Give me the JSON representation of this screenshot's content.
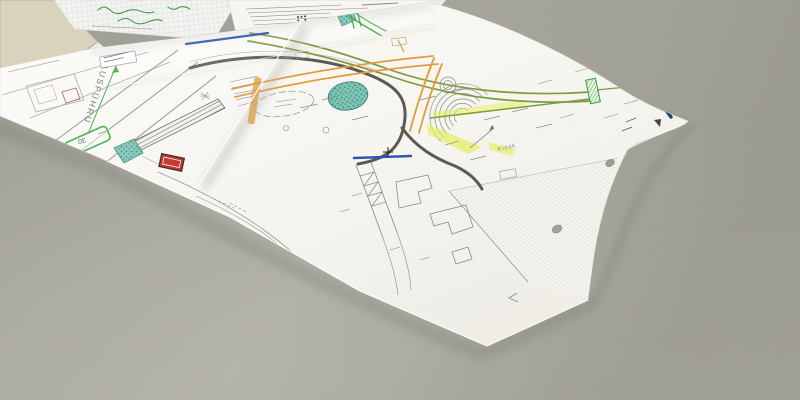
{
  "scene": {
    "labels": {
      "road_marking_vertical": "AUSFÜHRU",
      "green_box": "30",
      "kiosk": "Kiosk"
    },
    "colors": {
      "desk": "#a8a79e",
      "paper": "#f8f7f2",
      "route_orange": "#e39b3f",
      "route_green": "#7e9b3e",
      "highlight_green": "#35a53f",
      "highlight_yellow": "#e6ef5e",
      "line_blue": "#2b55b0",
      "line_navy": "#1d3e86",
      "area_teal": "#7ec4b4",
      "marker_red": "#c03028",
      "handwriting_green": "#3f9d44"
    }
  }
}
